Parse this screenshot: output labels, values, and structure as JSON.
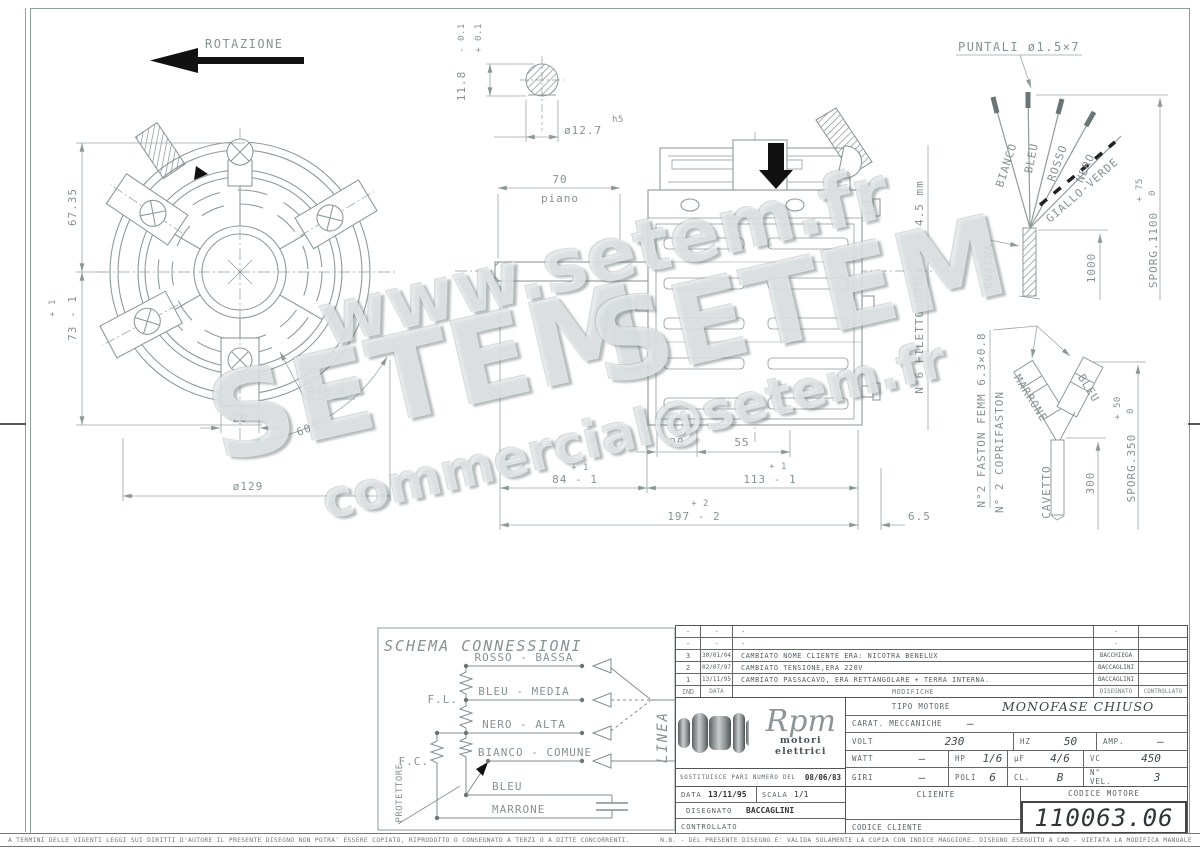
{
  "drawing": {
    "rotazione": "ROTAZIONE",
    "front": {
      "dim_height_top": "67.35",
      "dim_height_tol": "+ 1",
      "dim_height": "73 - 1",
      "dim_tab": "20",
      "dim_dia": "ø129",
      "dim_radius": "R48.5",
      "dim_angle": "60°"
    },
    "shaft": {
      "tol_minus": "- 0.1",
      "tol_plus": "+ 0.1",
      "dim_flat": "11.8",
      "dim_dia": "ø12.7",
      "dia_fit": "h5"
    },
    "side": {
      "dim_70": "70",
      "piano": "piano",
      "dim_20": "20",
      "dim_55": "55",
      "tol_84": "+ 1",
      "dim_84": "84 - 1",
      "tol_113": "+ 1",
      "dim_113": "113 - 1",
      "tol_197": "+ 2",
      "dim_197": "197 - 2",
      "dim_65": "6.5",
      "thread": "N°6 FILETTO UTILE 4 ÷ 4.5 mm"
    },
    "leads": {
      "title": "PUNTALI ø1.5×7",
      "wire_bianco": "BIANCO",
      "wire_bleu": "BLEU",
      "wire_rosso": "ROSSO",
      "wire_nero": "NERO",
      "wire_gv": "GIALLO-VERDE",
      "guaina": "GUAINA",
      "dim_1000": "1000",
      "sporg": "SPORG.1100",
      "sporg_tol_plus": "+ 75",
      "sporg_tol_zero": "0"
    },
    "faston": {
      "note1": "N°2 FASTON FEMM 6.3×0.8",
      "note2": "N° 2 COPRIFASTON",
      "marrone": "MARRONE",
      "bleu": "BLEU",
      "cavetto": "CAVETTO",
      "dim_300": "300",
      "sporg": "SPORG.350",
      "tol_plus": "+ 50",
      "tol_zero": "0"
    }
  },
  "schema": {
    "title": "SCHEMA CONNESSIONI",
    "rosso": "ROSSO - BASSA",
    "bleu_media": "BLEU - MEDIA",
    "nero": "NERO - ALTA",
    "bianco": "BIANCO - COMUNE",
    "bleu": "BLEU",
    "marrone": "MARRONE",
    "fl": "F.L.",
    "fc": "F.C.",
    "protettore": "PROTETTORE",
    "linea": "LINEA"
  },
  "title_block": {
    "mods": {
      "rows": [
        {
          "ind": "-",
          "date": "-",
          "desc": "-",
          "by": "-"
        },
        {
          "ind": "-",
          "date": "-",
          "desc": "-",
          "by": "-"
        },
        {
          "ind": "3",
          "date": "30/01/04",
          "desc": "CAMBIATO NOME CLIENTE ERA: NICOTRA BENELUX",
          "by": "BACCHIEGA"
        },
        {
          "ind": "2",
          "date": "02/07/97",
          "desc": "CAMBIATO TENSIONE,ERA 220V",
          "by": "BACCAGLINI"
        },
        {
          "ind": "1",
          "date": "13/11/95",
          "desc": "CAMBIATO PASSACAVO, ERA RETTANGOLARE + TERRA INTERNA.",
          "by": "BACCAGLINI"
        }
      ],
      "h_ind": "IND",
      "h_date": "DATA",
      "h_desc": "MODIFICHE",
      "h_dis": "DISEGNATO",
      "h_con": "CONTROLLATO"
    },
    "logo_name": "Rpm",
    "logo_sub": "motori elettrici",
    "sostituisce": "SOSTITUISCE PARI NUMERO DEL",
    "sostituisce_date": "08/06/83",
    "tipo_label": "TIPO MOTORE",
    "tipo_value": "MONOFASE CHIUSO",
    "carat_label": "CARAT. MECCANICHE",
    "carat_value": "—",
    "volt_label": "VOLT",
    "volt": "230",
    "hz_label": "HZ",
    "hz": "50",
    "amp_label": "AMP.",
    "amp": "—",
    "watt_label": "WATT",
    "watt": "—",
    "hp_label": "HP",
    "hp": "1/6",
    "uf_label": "µF",
    "uf": "4/6",
    "vc_label": "VC",
    "vc": "450",
    "giri_label": "GIRI",
    "giri": "—",
    "poli_label": "POLI",
    "poli": "6",
    "cl_label": "CL.",
    "cl": "B",
    "nvel_label": "N° VEL.",
    "nvel": "3",
    "data_label": "DATA",
    "data_value": "13/11/95",
    "scala_label": "SCALA",
    "scala_value": "1/1",
    "cliente_label": "CLIENTE",
    "codice_motore_label": "CODICE MOTORE",
    "codice_motore": "110063.06",
    "disegnato_label": "DISEGNATO",
    "disegnato_value": "BACCAGLINI",
    "controllato_label": "CONTROLLATO",
    "codice_cliente_label": "CODICE CLIENTE"
  },
  "watermark": {
    "www": "www.setem.fr",
    "setem": "SETEM",
    "email": "commercial@setem.fr"
  },
  "footer": {
    "left": "A TERMINI DELLE VIGENTI LEGGI SUI DIRITTI D'AUTORE IL PRESENTE DISEGNO NON POTRA' ESSERE COPIATO, RIPRODOTTO O CONSEGNATO A TERZI O A DITTE CONCORRENTI.",
    "right": "N.B. - DEL PRESENTE DISEGNO E' VALIDA SOLAMENTE LA COPIA CON INDICE MAGGIORE.    DISEGNO ESEGUITO A CAD - VIETATA LA MODIFICA MANUALE"
  }
}
